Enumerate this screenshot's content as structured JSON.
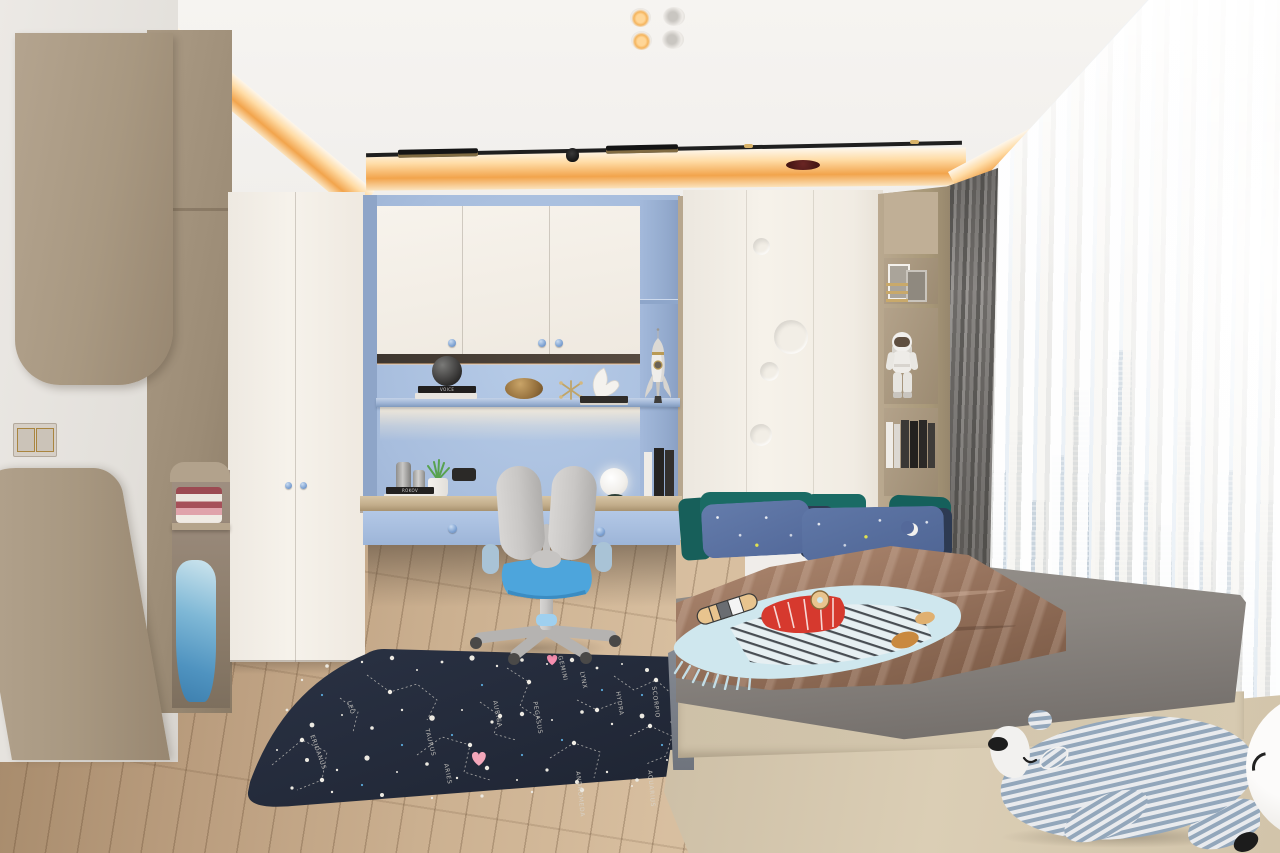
{
  "scene": {
    "subject": "children's bedroom interior render",
    "style": "modern white + taupe wood + powder blue"
  },
  "palette": {
    "cove_light": "#f2a44c",
    "wood_cabinet": "#b0a08c",
    "white_cabinet": "#f5f1ea",
    "alcove_blue": "#a7bddd",
    "drawer_blue": "#a9c0e0",
    "desk_wood": "#c9b492",
    "teal_pillow": "#1a6b64",
    "star_pillow_blue": "#5a72a2",
    "duvet_brown": "#97725d",
    "mattress_gray": "#8a8581",
    "platform_wood": "#d6c9b0",
    "rug_navy": "#232a39",
    "chair_seat_blue": "#4da5dc",
    "floor_wood": "#c3a887",
    "blackout_curtain_gray": "#7b7976",
    "sky": "#dfe9f1",
    "heart_pink": "#f4a7ba"
  },
  "lighting": {
    "downlights": "4 recessed ceiling spots, 2 lit warm",
    "track": "black linear track light",
    "cove": "warm LED cove strip around dropped ceiling"
  },
  "rug": {
    "description": "dark navy constellation star-map rug",
    "constellations": [
      "LEO",
      "ERIDANUS",
      "TAURUS",
      "ARIES",
      "AURIGA",
      "PEGASUS",
      "GEMINI",
      "LYNX",
      "HYDRA",
      "SCORPIO",
      "ANDROMEDA",
      "AQUARIUS"
    ],
    "accents": "white star dots, dotted constellation lines, blue specks, pink hearts"
  },
  "books": {
    "spine_a": "VOICE",
    "spine_b": "ROKOV"
  },
  "objects": {
    "rocket_model": "white rocket figurine",
    "astronaut_figurine": "astronaut toy on wood shelf",
    "plush_bear": "blue-white striped sleeping plush bear",
    "globe_lamp": "white globe desk lamp, dark green base",
    "plant": "potted succulent",
    "clothes": "folded pink/white clothes and hanging blue garment",
    "throw_blanket": "light blue illustrated throw with fringe",
    "window_view": "city skyline behind sheer curtains"
  }
}
